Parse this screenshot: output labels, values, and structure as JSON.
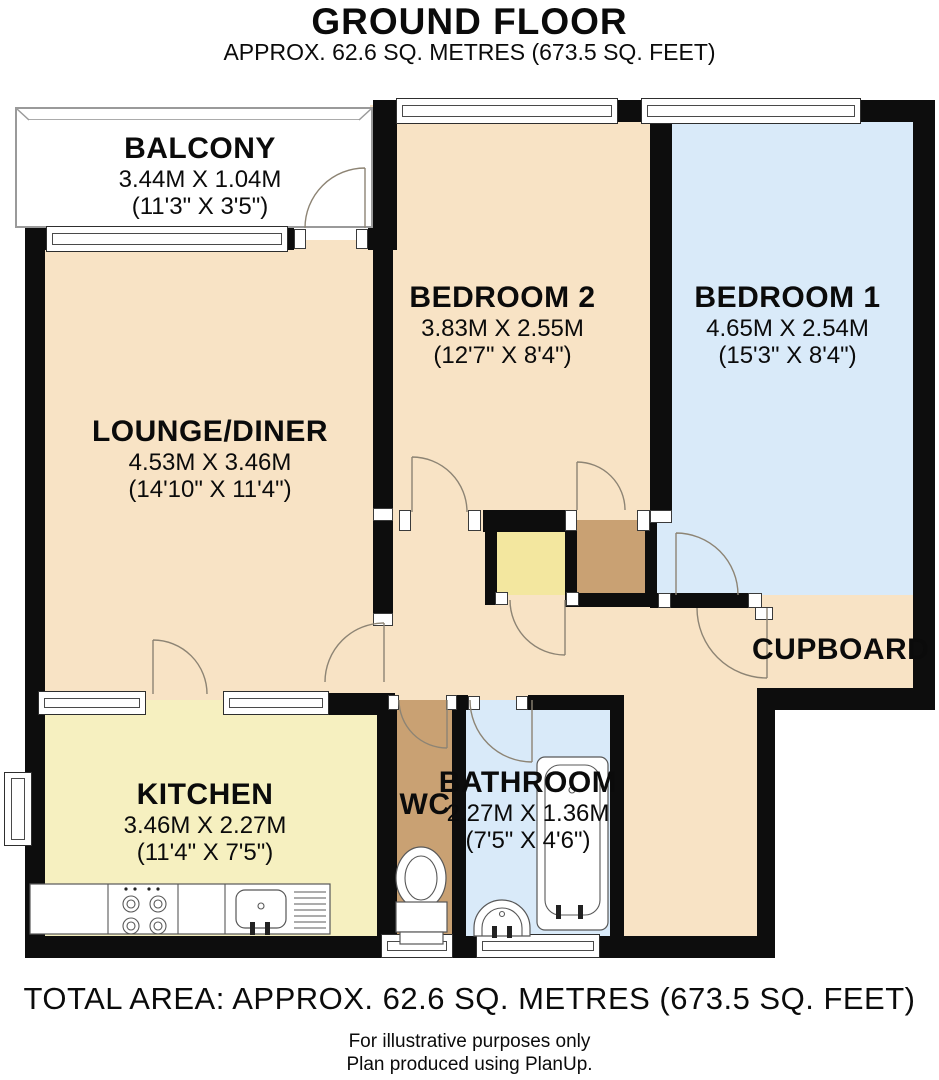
{
  "title": {
    "main": "GROUND FLOOR",
    "subtitle": "APPROX. 62.6 SQ. METRES (673.5 SQ. FEET)"
  },
  "rooms": {
    "balcony": {
      "name": "BALCONY",
      "metric": "3.44M X 1.04M",
      "imperial": "(11'3\" X 3'5\")"
    },
    "lounge": {
      "name": "LOUNGE/DINER",
      "metric": "4.53M X 3.46M",
      "imperial": "(14'10\" X 11'4\")"
    },
    "bedroom2": {
      "name": "BEDROOM 2",
      "metric": "3.83M X 2.55M",
      "imperial": "(12'7\" X 8'4\")"
    },
    "bedroom1": {
      "name": "BEDROOM 1",
      "metric": "4.65M X 2.54M",
      "imperial": "(15'3\" X 8'4\")"
    },
    "kitchen": {
      "name": "KITCHEN",
      "metric": "3.46M X 2.27M",
      "imperial": "(11'4\" X 7'5\")"
    },
    "bathroom": {
      "name": "BATHROOM",
      "metric": "2.27M X 1.36M",
      "imperial": "(7'5\" X 4'6\")"
    },
    "wc": {
      "name": "WC"
    },
    "cupboard": {
      "name": "CUPBOARD"
    }
  },
  "footer": {
    "total": "TOTAL AREA: APPROX. 62.6 SQ. METRES (673.5 SQ. FEET)",
    "note1": "For illustrative purposes only",
    "note2": "Plan produced using PlanUp."
  },
  "colors": {
    "wall": "#0d0d0d",
    "cream": "#F8E3C5",
    "blue": "#D9EAF9",
    "kitchen_yellow": "#F6F0C0",
    "store_yellow": "#F3E79F",
    "brown": "#C9A173",
    "line": "#8d8474"
  },
  "fixtures": [
    "worktop",
    "hob",
    "sink-drainer",
    "toilet",
    "basin",
    "bathtub"
  ]
}
